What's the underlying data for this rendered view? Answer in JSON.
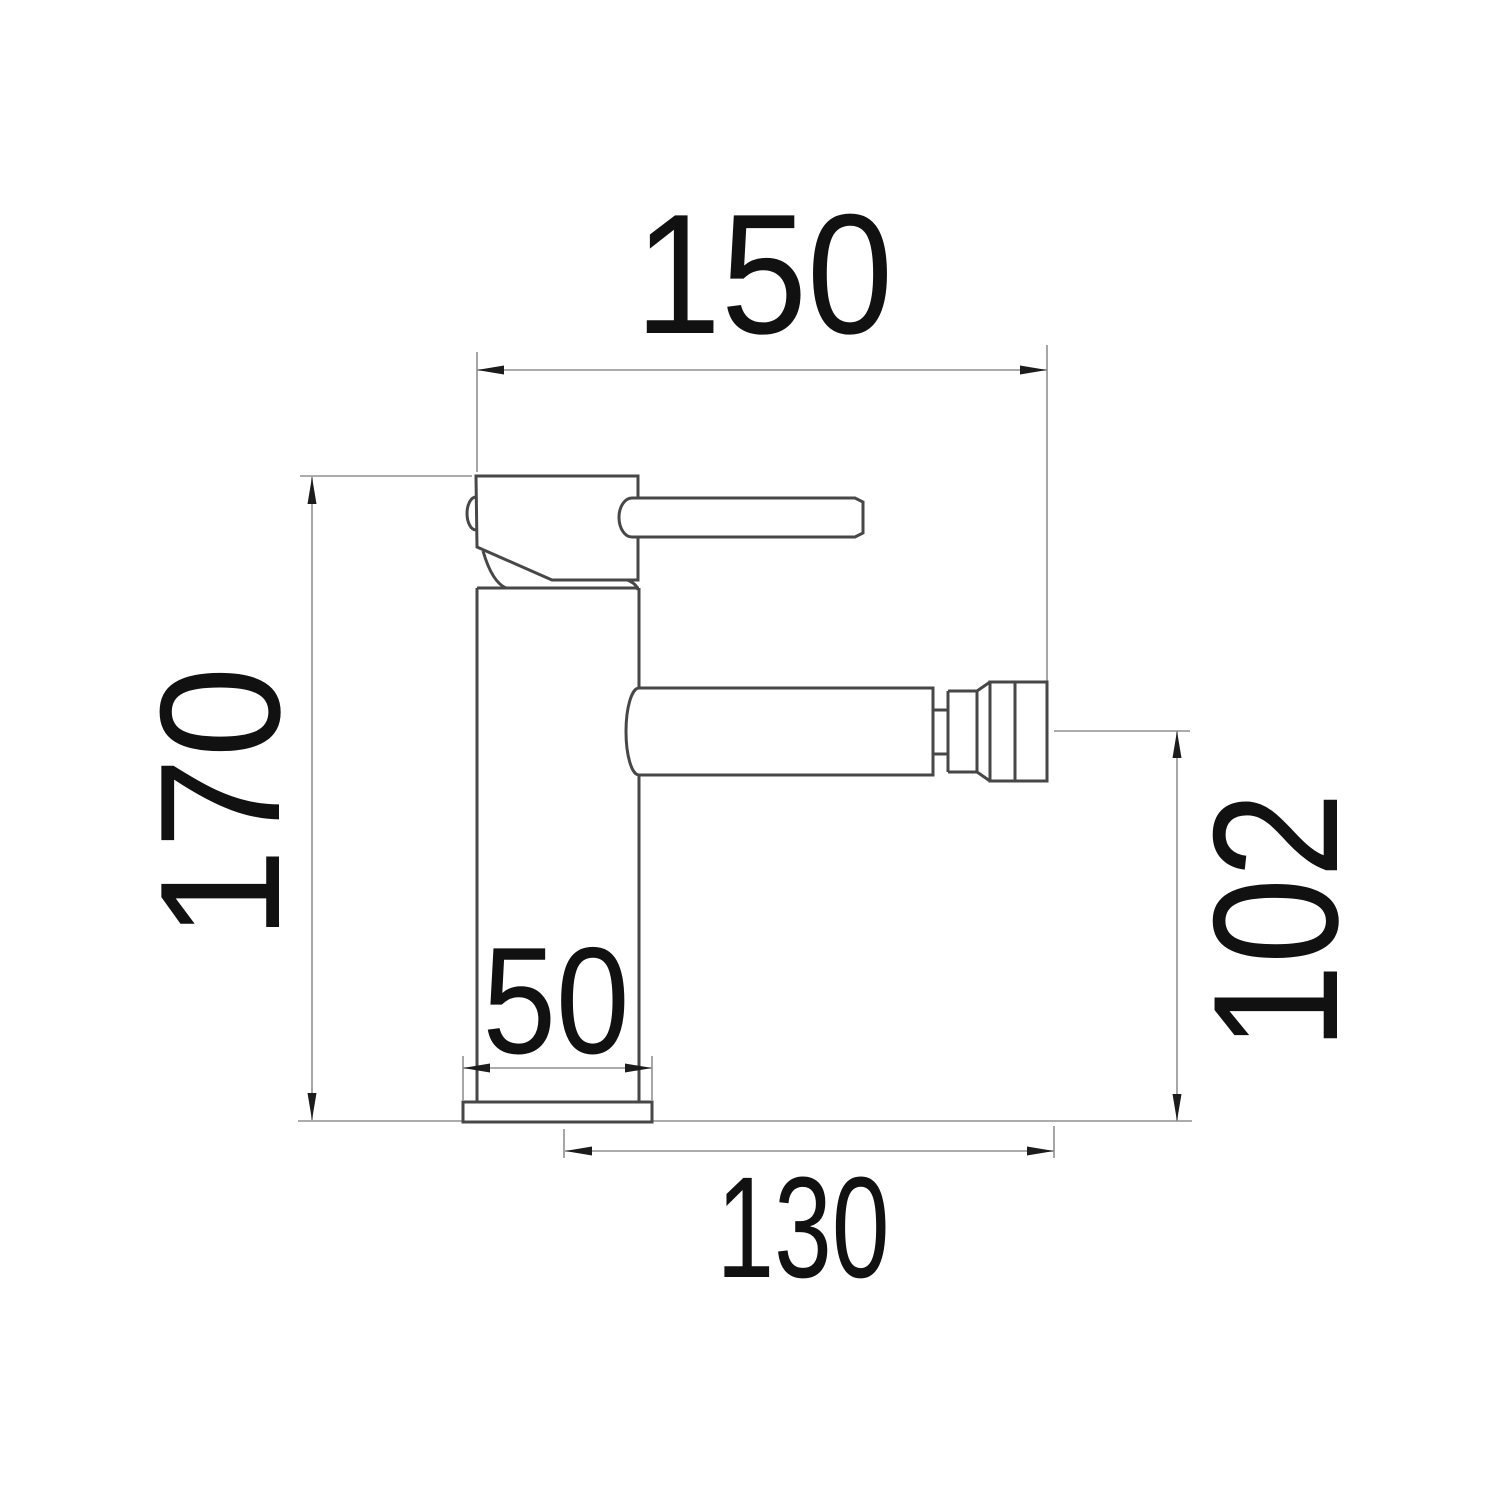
{
  "colors": {
    "outline": "#474747",
    "dimension_line": "#8f8f8f",
    "arrow": "#1c1c1c",
    "label": "#111111",
    "background": "#ffffff"
  },
  "dimension_labels": {
    "overall_width": "150",
    "overall_height": "170",
    "spout_center_height": "102",
    "base_width": "50",
    "spout_reach": "130"
  }
}
